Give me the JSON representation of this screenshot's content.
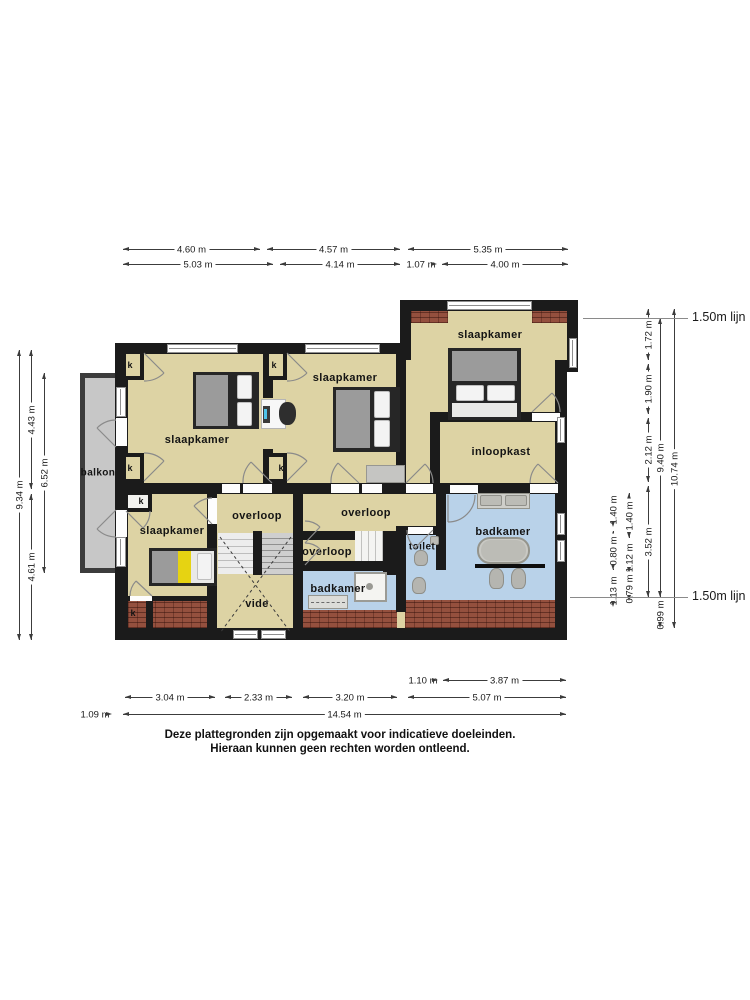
{
  "disclaimer": {
    "line1": "Deze plattegronden zijn opgemaakt voor indicatieve doeleinden.",
    "line2": "Hieraan kunnen geen rechten worden ontleend."
  },
  "closet_label": "k",
  "room_labels": [
    {
      "name": "slaapkamer-topleft",
      "text": "slaapkamer",
      "x": 197,
      "y": 440
    },
    {
      "name": "slaapkamer-middle",
      "text": "slaapkamer",
      "x": 345,
      "y": 378
    },
    {
      "name": "slaapkamer-topright",
      "text": "slaapkamer",
      "x": 490,
      "y": 335
    },
    {
      "name": "inloopkast",
      "text": "inloopkast",
      "x": 501,
      "y": 452
    },
    {
      "name": "slaapkamer-bottomleft",
      "text": "slaapkamer",
      "x": 172,
      "y": 531
    },
    {
      "name": "overloop-left",
      "text": "overloop",
      "x": 257,
      "y": 516
    },
    {
      "name": "overloop-middle",
      "text": "overloop",
      "x": 366,
      "y": 513
    },
    {
      "name": "overloop-small",
      "text": "overloop",
      "x": 327,
      "y": 552
    },
    {
      "name": "toilet",
      "text": "toilet",
      "x": 422,
      "y": 547,
      "size": 10
    },
    {
      "name": "badkamer-right",
      "text": "badkamer",
      "x": 503,
      "y": 532
    },
    {
      "name": "badkamer-small",
      "text": "badkamer",
      "x": 338,
      "y": 589
    },
    {
      "name": "vide",
      "text": "vide",
      "x": 257,
      "y": 604
    },
    {
      "name": "balkon",
      "text": "balkon",
      "x": 98,
      "y": 473,
      "size": 10
    }
  ],
  "closets": [
    {
      "x": 130,
      "y": 365
    },
    {
      "x": 274,
      "y": 365
    },
    {
      "x": 130,
      "y": 468
    },
    {
      "x": 281,
      "y": 468
    },
    {
      "x": 141,
      "y": 501
    },
    {
      "x": 133,
      "y": 613
    }
  ],
  "dimensions": {
    "top": [
      {
        "text": "4.60 m",
        "x1": 123,
        "x2": 260,
        "y": 249
      },
      {
        "text": "4.57 m",
        "x1": 267,
        "x2": 400,
        "y": 249
      },
      {
        "text": "5.35 m",
        "x1": 408,
        "x2": 568,
        "y": 249
      },
      {
        "text": "5.03 m",
        "x1": 123,
        "x2": 273,
        "y": 264
      },
      {
        "text": "4.14 m",
        "x1": 280,
        "x2": 400,
        "y": 264
      },
      {
        "text": "1.07 m",
        "x1": 405,
        "x2": 437,
        "y": 264
      },
      {
        "text": "4.00 m",
        "x1": 442,
        "x2": 568,
        "y": 264
      }
    ],
    "bottom": [
      {
        "text": "1.10 m",
        "x1": 408,
        "x2": 438,
        "y": 680
      },
      {
        "text": "3.87 m",
        "x1": 443,
        "x2": 566,
        "y": 680
      },
      {
        "text": "3.04 m",
        "x1": 125,
        "x2": 215,
        "y": 697
      },
      {
        "text": "2.33 m",
        "x1": 225,
        "x2": 292,
        "y": 697
      },
      {
        "text": "3.20 m",
        "x1": 303,
        "x2": 397,
        "y": 697
      },
      {
        "text": "5.07 m",
        "x1": 408,
        "x2": 566,
        "y": 697
      },
      {
        "text": "1.09 m",
        "x1": 78,
        "x2": 112,
        "y": 714
      },
      {
        "text": "14.54 m",
        "x1": 123,
        "x2": 566,
        "y": 714
      }
    ],
    "left": [
      {
        "text": "9.34 m",
        "x": 19,
        "y1": 350,
        "y2": 640
      },
      {
        "text": "4.43 m",
        "x": 31,
        "y1": 350,
        "y2": 489
      },
      {
        "text": "4.61 m",
        "x": 31,
        "y1": 494,
        "y2": 640
      },
      {
        "text": "6.52 m",
        "x": 44,
        "y1": 373,
        "y2": 573
      }
    ],
    "right": [
      {
        "text": "1.40 m",
        "x": 613,
        "y1": 493,
        "y2": 527
      },
      {
        "text": "0.80 m",
        "x": 613,
        "y1": 531,
        "y2": 570
      },
      {
        "text": "1.13 m",
        "x": 613,
        "y1": 574,
        "y2": 607
      },
      {
        "text": "1.40 m",
        "x": 629,
        "y1": 493,
        "y2": 538
      },
      {
        "text": "1.12 m",
        "x": 629,
        "y1": 542,
        "y2": 573
      },
      {
        "text": "0.79 m",
        "x": 629,
        "y1": 577,
        "y2": 601
      },
      {
        "text": "1.72 m",
        "x": 648,
        "y1": 309,
        "y2": 360
      },
      {
        "text": "1.90 m",
        "x": 648,
        "y1": 364,
        "y2": 414
      },
      {
        "text": "2.12 m",
        "x": 648,
        "y1": 418,
        "y2": 482
      },
      {
        "text": "3.52 m",
        "x": 648,
        "y1": 486,
        "y2": 597
      },
      {
        "text": "9.40 m",
        "x": 660,
        "y1": 318,
        "y2": 597
      },
      {
        "text": "0.99 m",
        "x": 660,
        "y1": 601,
        "y2": 628
      },
      {
        "text": "10.74 m",
        "x": 674,
        "y1": 309,
        "y2": 628
      }
    ]
  },
  "level_lines": [
    {
      "text": "1.50m lijn",
      "x1": 583,
      "x2": 688,
      "y": 318
    },
    {
      "text": "1.50m lijn",
      "x1": 570,
      "x2": 688,
      "y": 597
    }
  ],
  "colors": {
    "floor": "#ddd3a4",
    "wall": "#1b1b1b",
    "bathroom": "#b9d2e9",
    "balcony": "#c7c7c7",
    "brick": "#94503e",
    "accent_yellow": "#e6d312"
  }
}
